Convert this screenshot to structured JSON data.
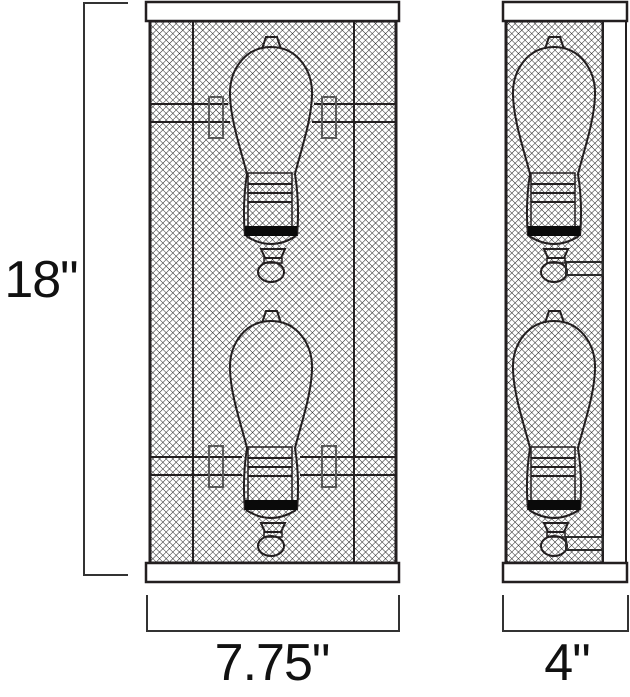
{
  "diagram": {
    "height_label": "18\"",
    "width_label": "7.75\"",
    "depth_label": "4\""
  },
  "colors": {
    "line": "#231f20",
    "background": "#ffffff",
    "bulb_band": "#0a0a0a",
    "dimension_line": "#333333"
  }
}
